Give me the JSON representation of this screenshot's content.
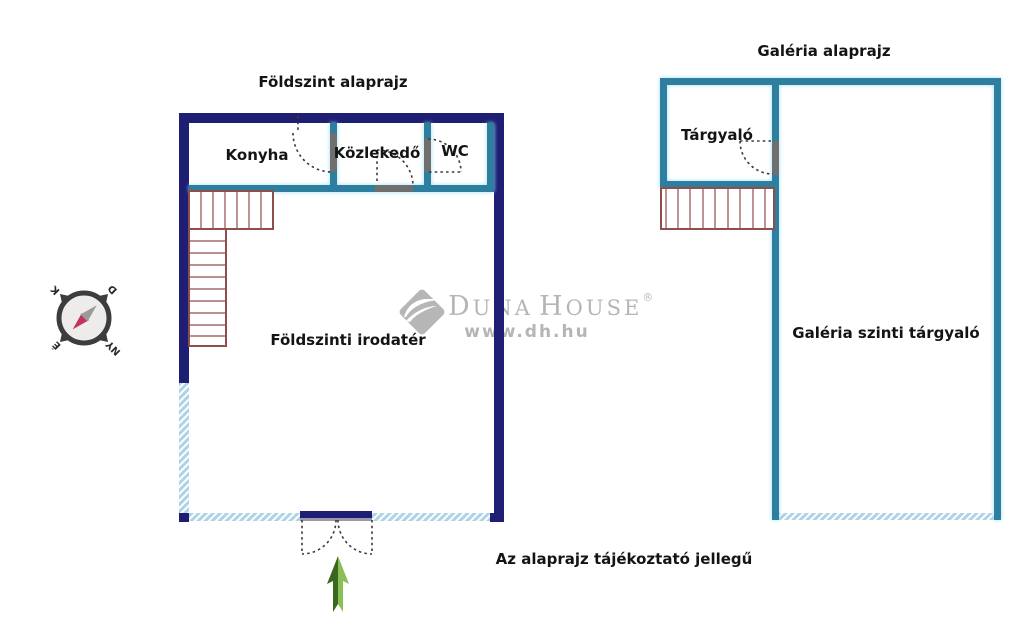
{
  "colors": {
    "navy": "#1e1e73",
    "teal": "#2e7f9f",
    "window_blue": "#aed3e7",
    "stair_red": "#8f4d4c",
    "door_gray": "#6f6f6f",
    "arc_dark": "#3a3a3a",
    "label_black": "#141414",
    "watermark_gray": "#b5b5b5",
    "arrow_green_light": "#8abf55",
    "arrow_green_dark": "#3a661f",
    "compass_ring": "#3d3d3d",
    "compass_face": "#edecea",
    "needle_red": "#c23355",
    "needle_gray": "#9a9a9a"
  },
  "ground_floor": {
    "title": "Földszint alaprajz",
    "rooms": {
      "kitchen": "Konyha",
      "hallway": "Közlekedő",
      "wc": "WC",
      "office": "Földszinti irodatér"
    }
  },
  "gallery_floor": {
    "title": "Galéria alaprajz",
    "rooms": {
      "meeting": "Tárgyaló",
      "gallery_meeting": "Galéria szinti tárgyaló"
    }
  },
  "compass": {
    "north": "É",
    "south": "D",
    "east": "K",
    "west": "NY"
  },
  "watermark": {
    "brand_initial_1": "D",
    "brand_rest_1": "UNA",
    "brand_initial_2": "H",
    "brand_rest_2": "OUSE",
    "registered": "®",
    "website": "www.dh.hu"
  },
  "footnote": "Az alaprajz tájékoztató jellegű"
}
